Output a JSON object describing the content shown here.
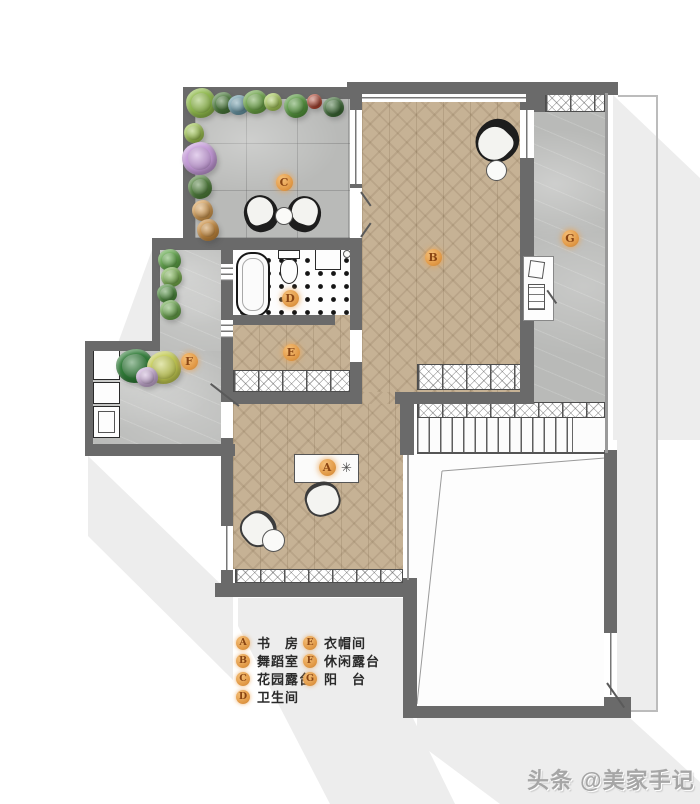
{
  "watermark": {
    "text": "头条 @美家手记"
  },
  "legend": {
    "items": [
      {
        "key": "A",
        "label": "书　房"
      },
      {
        "key": "B",
        "label": "舞蹈室"
      },
      {
        "key": "C",
        "label": "花园露台"
      },
      {
        "key": "D",
        "label": "卫生间"
      },
      {
        "key": "E",
        "label": "衣帽间"
      },
      {
        "key": "F",
        "label": "休闲露台"
      },
      {
        "key": "G",
        "label": "阳　台"
      }
    ]
  },
  "colors": {
    "wall": "#6a6a6a",
    "wood": "#c6b295",
    "stone": "#b9bab8",
    "marker": "#e29a47",
    "markertext": "#8a4513",
    "shadow": "#ededed",
    "legendtext": "#2a2a2a",
    "watermark": "#a6a6a6"
  }
}
